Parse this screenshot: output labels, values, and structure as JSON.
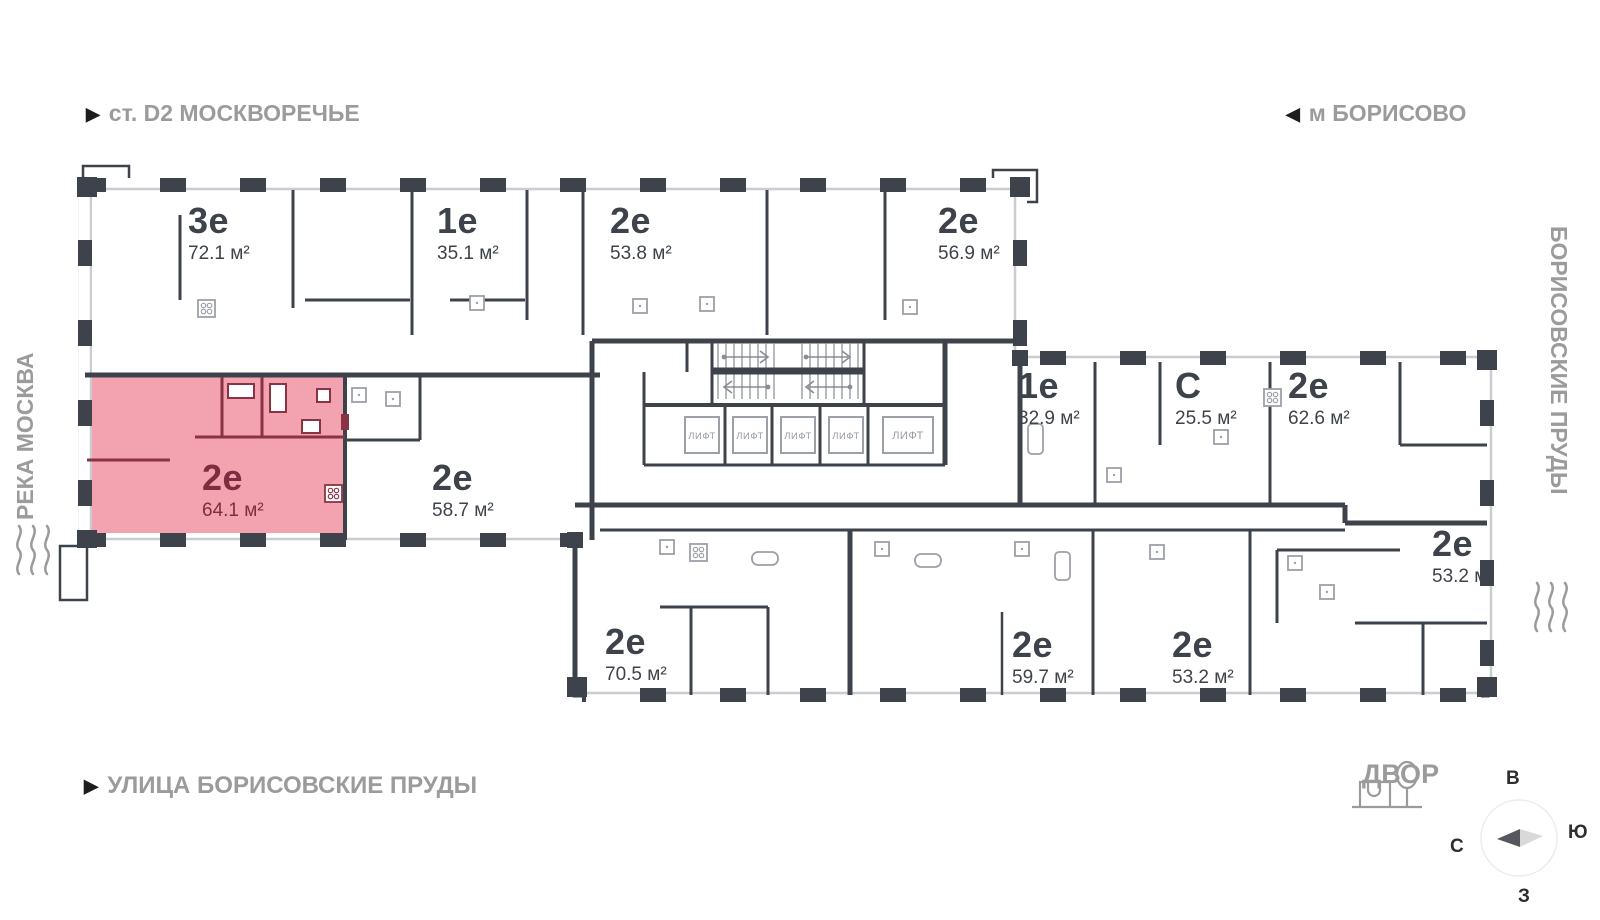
{
  "landmarks": {
    "station": "ст. D2 МОСКВОРЕЧЬЕ",
    "metro": "м БОРИСОВО",
    "river": "РЕКА МОСКВА",
    "ponds": "БОРИСОВСКИЕ ПРУДЫ",
    "street": "УЛИЦА БОРИСОВСКИЕ ПРУДЫ",
    "yard": "ДВОР",
    "marker_right": "▶",
    "marker_left": "◀"
  },
  "compass": {
    "north": "С",
    "south": "Ю",
    "east": "В",
    "west": "З"
  },
  "elevator_label": "ЛИФТ",
  "units": [
    {
      "type": "3е",
      "area": "72.1 м²",
      "highlighted": false
    },
    {
      "type": "1е",
      "area": "35.1 м²",
      "highlighted": false
    },
    {
      "type": "2е",
      "area": "53.8 м²",
      "highlighted": false
    },
    {
      "type": "2е",
      "area": "56.9 м²",
      "highlighted": false
    },
    {
      "type": "2е",
      "area": "64.1 м²",
      "highlighted": true
    },
    {
      "type": "2е",
      "area": "58.7 м²",
      "highlighted": false
    },
    {
      "type": "1е",
      "area": "32.9 м²",
      "highlighted": false
    },
    {
      "type": "С",
      "area": "25.5 м²",
      "highlighted": false
    },
    {
      "type": "2е",
      "area": "62.6 м²",
      "highlighted": false
    },
    {
      "type": "2е",
      "area": "53.2 м²",
      "highlighted": false
    },
    {
      "type": "2е",
      "area": "70.5 м²",
      "highlighted": false
    },
    {
      "type": "2е",
      "area": "59.7 м²",
      "highlighted": false
    },
    {
      "type": "2е",
      "area": "53.2 м²",
      "highlighted": false
    }
  ],
  "colors": {
    "wall": "#3E434B",
    "highlight_fill": "#F3A2AF",
    "highlight_wall": "#8A3344",
    "highlight_text": "#7E2D3E",
    "muted_text": "#9B9B9B"
  }
}
